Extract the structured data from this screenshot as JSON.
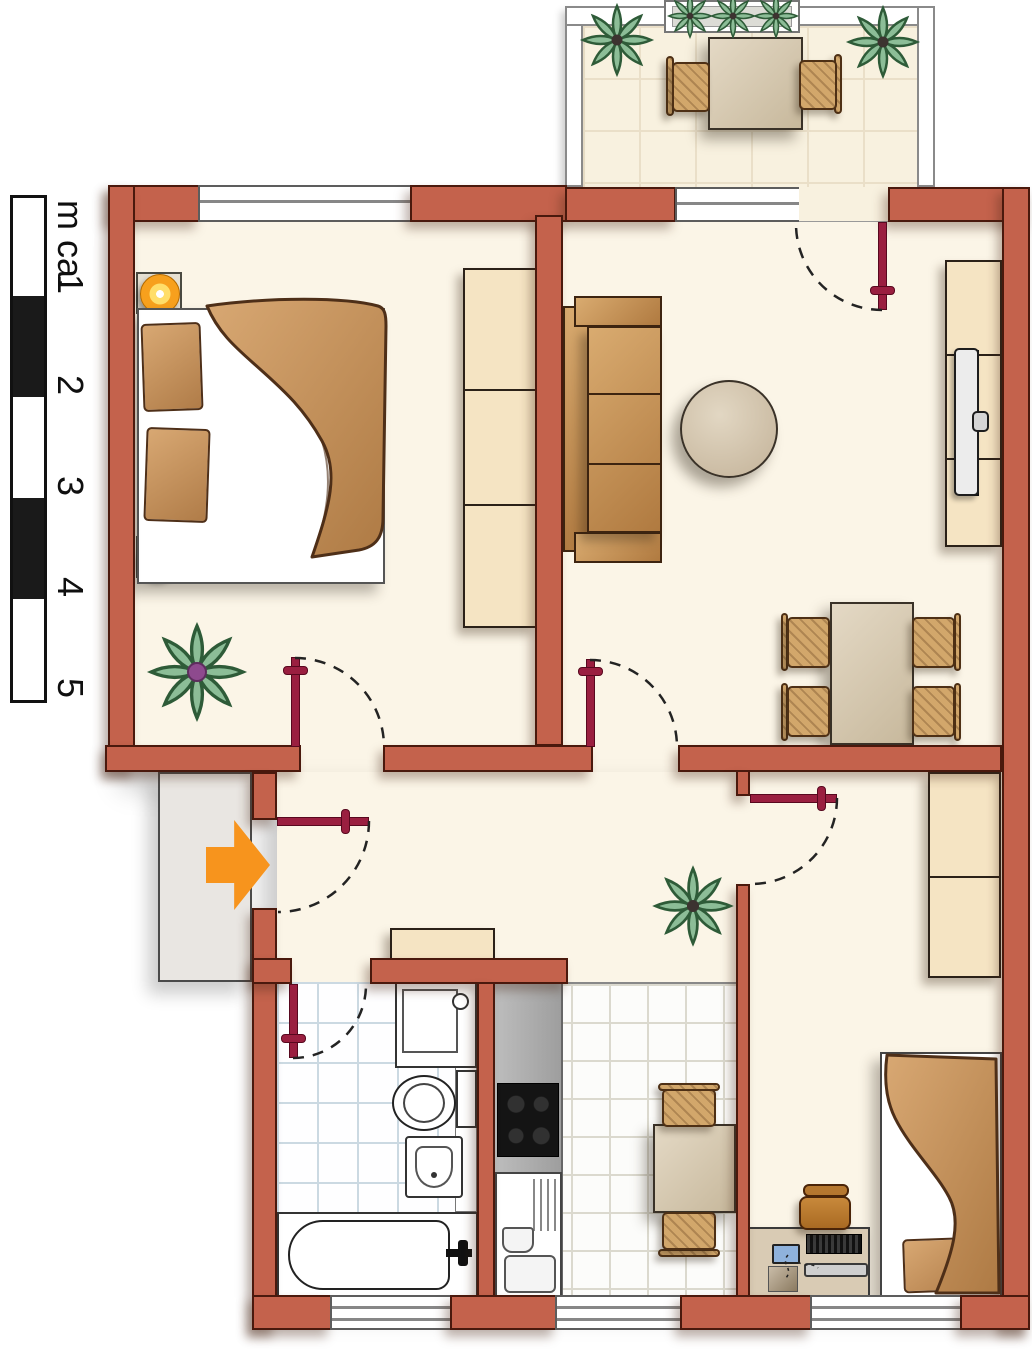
{
  "scale_bar": {
    "unit_label": "m ca.",
    "ticks": [
      "1",
      "2",
      "3",
      "4",
      "5"
    ]
  },
  "palette": {
    "wall": "#C4624C",
    "door_leaf": "#9A1F40",
    "entry_arrow": "#F7941D",
    "floor": "#FBF5E7",
    "balcony_floor": "#F8F1DF",
    "landing": "#E9E6E2",
    "furniture_cream": "#F5E4C3",
    "furniture_wood": "#C79455",
    "lamp": "#F7A01D",
    "plant": "#8CBD97",
    "kitchen_counter": "#ACACAC",
    "stove": "#141414"
  },
  "rooms": {
    "bedroom_main": {
      "furniture": [
        "double-bed",
        "pillow",
        "pillow",
        "nightstand-lamp",
        "nightstand-lamp",
        "wardrobe",
        "plant"
      ]
    },
    "living_room": {
      "furniture": [
        "sofa",
        "round-table",
        "tv-sideboard",
        "dining-table",
        "chair",
        "chair",
        "chair",
        "chair"
      ]
    },
    "balcony": {
      "furniture": [
        "planter-box",
        "corner-plant",
        "corner-plant",
        "table",
        "chair",
        "chair"
      ]
    },
    "hallway": {
      "furniture": [
        "shelf",
        "plant"
      ],
      "entry_arrow": true
    },
    "bathroom": {
      "furniture": [
        "shower",
        "toilet",
        "sink",
        "bathtub"
      ]
    },
    "kitchen": {
      "furniture": [
        "counter",
        "stove",
        "sink-unit",
        "table",
        "chair",
        "chair"
      ]
    },
    "bedroom_second": {
      "furniture": [
        "single-bed",
        "pillow",
        "desk",
        "computer",
        "office-chair",
        "wardrobe"
      ]
    }
  },
  "doors": [
    "entrance",
    "bedroom-main",
    "living-room",
    "balcony",
    "bedroom-second",
    "bathroom"
  ],
  "windows": [
    "bedroom-main-north",
    "living-room-north",
    "bathroom-south",
    "kitchen-south",
    "bedroom-second-south"
  ]
}
